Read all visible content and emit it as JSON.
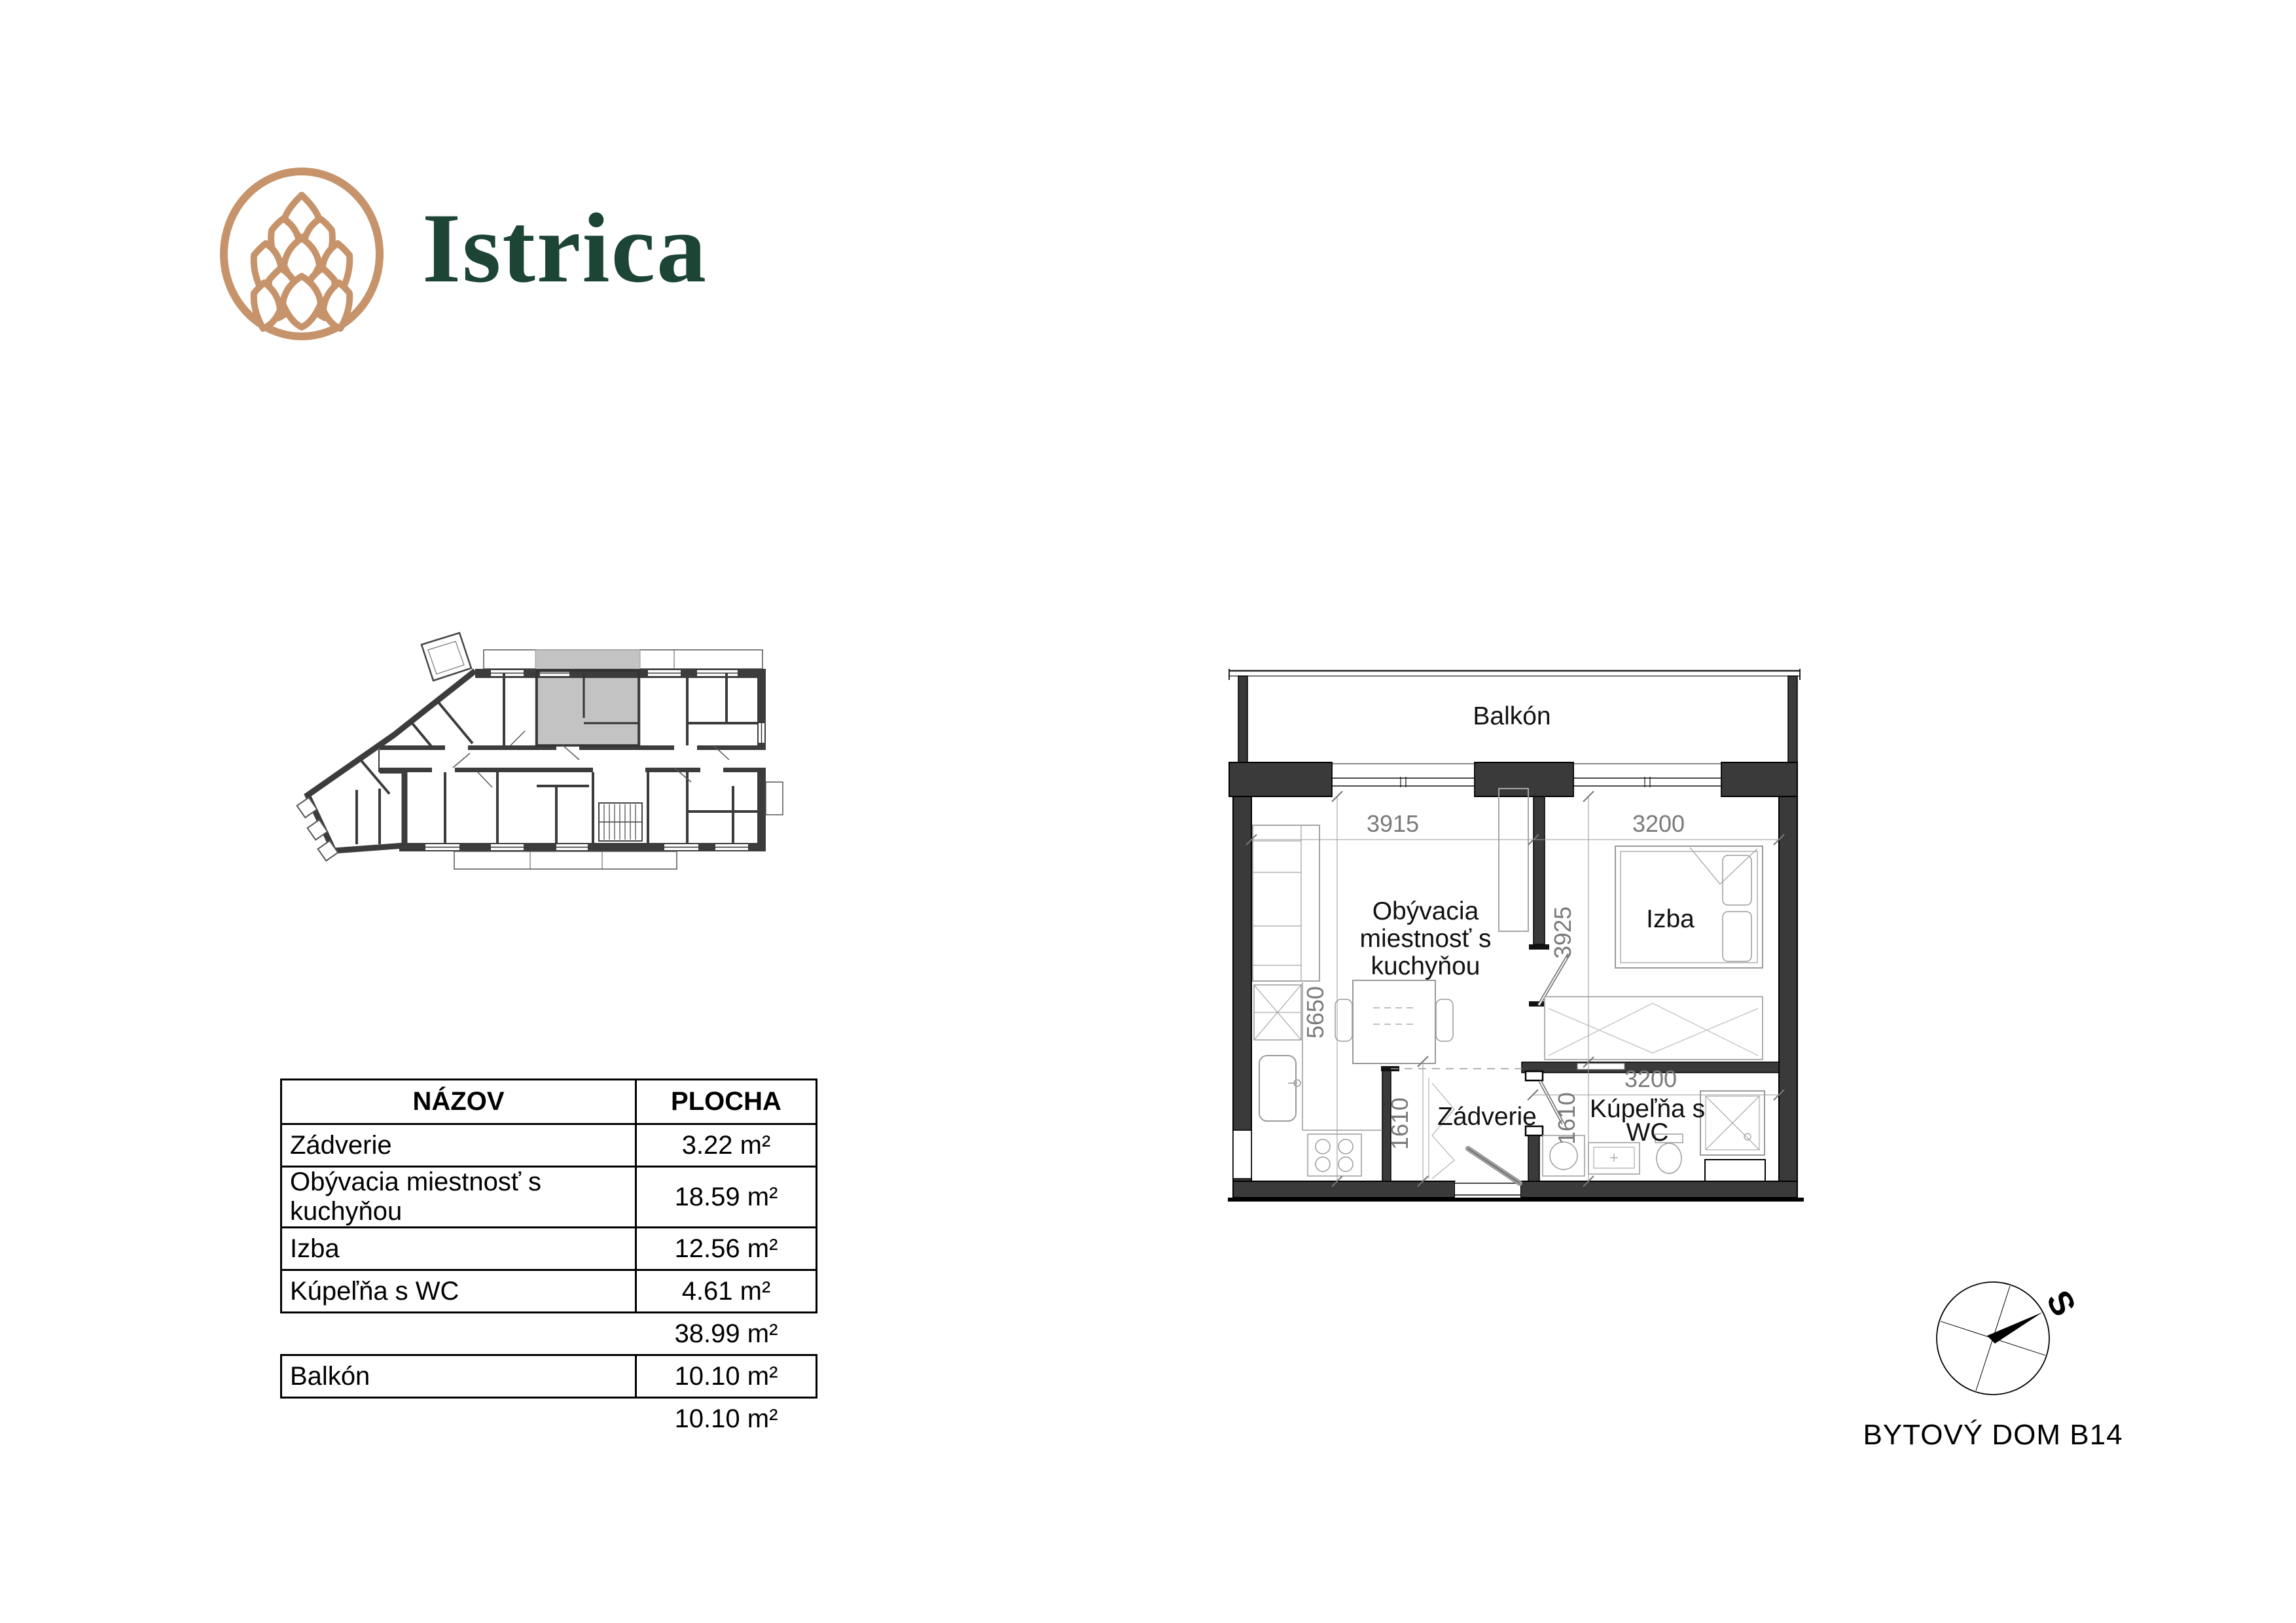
{
  "brand": {
    "name": "Istrica",
    "logo_color": "#C6936B",
    "text_color": "#1C4536"
  },
  "area_table": {
    "header": {
      "name": "NÁZOV",
      "area": "PLOCHA"
    },
    "rows": [
      {
        "name": "Zádverie",
        "area": "3.22 m²"
      },
      {
        "name": "Obývacia miestnosť s kuchyňou",
        "area": "18.59 m²"
      },
      {
        "name": "Izba",
        "area": "12.56 m²"
      },
      {
        "name": "Kúpeľňa s WC",
        "area": "4.61 m²"
      }
    ],
    "interior_total": "38.99 m²",
    "balcony_row": {
      "name": "Balkón",
      "area": "10.10 m²"
    },
    "balcony_total": "10.10 m²"
  },
  "floor_plan": {
    "room_labels": {
      "balcony": "Balkón",
      "living_line1": "Obývacia",
      "living_line2": "miestnosť s",
      "living_line3": "kuchyňou",
      "room": "Izba",
      "hall": "Zádverie",
      "bathroom_line1": "Kúpeľňa s",
      "bathroom_line2": "WC"
    },
    "dimensions": {
      "living_width": "3915",
      "room_width": "3200",
      "room_depth": "3925",
      "living_depth": "5650",
      "hall_depth": "1610",
      "bathroom_depth": "1610",
      "bathroom_width": "3200"
    },
    "wall_color": "#3A3A3A",
    "highlight_color": "#C3C3C3"
  },
  "compass": {
    "north_label": "S"
  },
  "footer": {
    "building_label": "BYTOVÝ DOM B14"
  }
}
